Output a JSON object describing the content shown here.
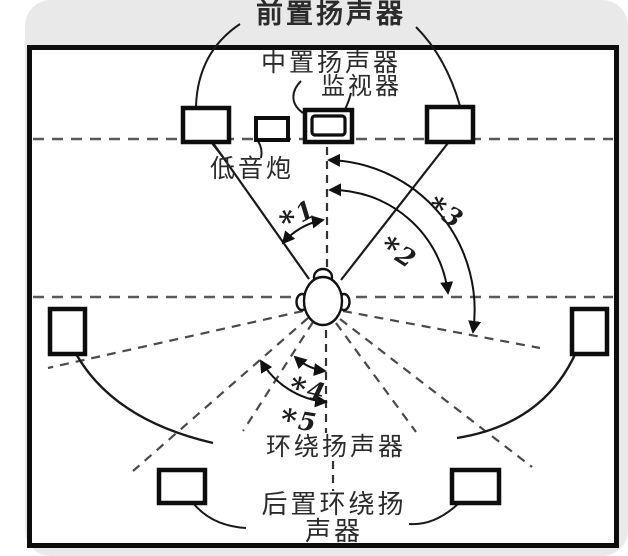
{
  "labels": {
    "front": "前置扬声器",
    "center": "中置扬声器",
    "monitor": "监视器",
    "subwoofer": "低音炮",
    "surround": "环绕扬声器",
    "rear_line1": "后置环绕扬",
    "rear_line2": "声器"
  },
  "markers": [
    {
      "star": "*",
      "num": "1"
    },
    {
      "star": "*",
      "num": "2"
    },
    {
      "star": "*",
      "num": "3"
    },
    {
      "star": "*",
      "num": "4"
    },
    {
      "star": "*",
      "num": "5"
    }
  ],
  "colors": {
    "line": "#1a1a1a",
    "dashed": "#4a4a4a",
    "page_bg": "#e9e9e9",
    "room_bg": "#ffffff",
    "border": "#0d0d0d"
  }
}
